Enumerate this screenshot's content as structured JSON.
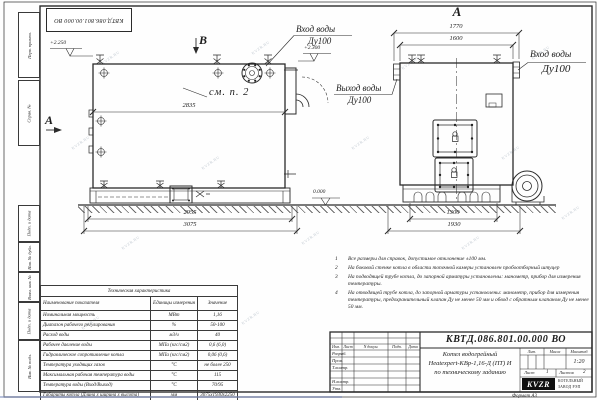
{
  "sheet": {
    "watermark": "KVZR.RU",
    "doc_number": "КВТД.086.801.00.000 ВО",
    "format_note": "Формат А3"
  },
  "margin_stamps": {
    "top": [
      "Перв. примен.",
      "Справ. №"
    ],
    "bottom": [
      "Подп. и дата",
      "Инв. № дубл.",
      "Взам. инв. №",
      "Подп. и дата",
      "Инв. № подл."
    ]
  },
  "drawing": {
    "view_b_label": "В",
    "view_a_arrow_label": "А",
    "view_a_title": "А",
    "see_item_note": "см. п. 2",
    "elevations": {
      "top_left": "+2.250",
      "top_right": "+2.300",
      "ground": "0.000"
    },
    "dims": {
      "d2835": "2835",
      "d2955": "2955",
      "d3075": "3075",
      "d1770": "1770",
      "d1600": "1600",
      "d1300": "1300",
      "d1930": "1930"
    },
    "labels": {
      "inlet_top": {
        "line1": "Вход воды",
        "line2": "Ду100"
      },
      "outlet": {
        "line1": "Выход воды",
        "line2": "Ду100"
      },
      "inlet_right": {
        "line1": "Вход воды",
        "line2": "Ду100"
      }
    }
  },
  "notes": [
    {
      "num": "1",
      "text": "Все размеры для справок, допустимое отклонение ±100 мм."
    },
    {
      "num": "2",
      "text": "На боковой стенке котла в области топочной камеры установлен пробоотборный штуцер"
    },
    {
      "num": "3",
      "text": "На подводящей трубе котла, до запорной арматуры установлены: манометр, прибор для измерения температуры."
    },
    {
      "num": "4",
      "text": "На отводящей трубе котла, до запорной арматуры установлены: манометр, прибор для измерения температуры, предохранительный клапан Ду не менее 50 мм и обвод с обратным клапаном Ду не менее 50 мм."
    }
  ],
  "tech_table": {
    "title": "Техническая характеристика",
    "col_name": "Наименование показателя",
    "col_units": "Единицы измерения",
    "col_value": "Значение",
    "rows": [
      {
        "name": "Номинальная мощность",
        "units": "МВт",
        "value": "1,16"
      },
      {
        "name": "Диапазон рабочего регулирования",
        "units": "%",
        "value": "50-100"
      },
      {
        "name": "Расход воды",
        "units": "м3/ч",
        "value": "40"
      },
      {
        "name": "Рабочее давление воды",
        "units": "МПа (кгс/см2)",
        "value": "0,6 (6,0)"
      },
      {
        "name": "Гидравлическое сопротивление котла",
        "units": "МПа (кгс/см2)",
        "value": "0,06 (0,6)"
      },
      {
        "name": "Температура уходящих газов",
        "units": "°С",
        "value": "не более 250"
      },
      {
        "name": "Максимальная рабочая температура воды",
        "units": "°С",
        "value": "115"
      },
      {
        "name": "Температура воды (Вход/Выход)",
        "units": "°С",
        "value": "70/95"
      },
      {
        "name": "Габариты котла (Длина х ширина х высота)",
        "units": "мм",
        "value": "3075х1930х2250"
      }
    ]
  },
  "title_block": {
    "doc_number": "КВТД.086.801.00.000 ВО",
    "header_cells": [
      "Изм.",
      "Лист",
      "N докум.",
      "Подп.",
      "Дата"
    ],
    "row_labels": [
      "Разраб.",
      "Пров.",
      "Т.контр.",
      "Н.контр.",
      "Утв."
    ],
    "title_line1": "Котел водогрейный",
    "title_line2": "Heatexpert-КВр-1,16-Д (ПТ) И",
    "title_line3": "по техническому заданию",
    "lit_label": "Лит.",
    "mass_label": "Масса",
    "scale_label": "Масштаб",
    "scale_value": "1:20",
    "sheet_label": "Лист",
    "sheet_value": "1",
    "sheets_label": "Листов",
    "sheets_value": "2",
    "logo_text": "KVZR",
    "logo_caption1": "КОТЕЛЬНЫЙ",
    "logo_caption2": "ЗАВОД РЭП"
  }
}
